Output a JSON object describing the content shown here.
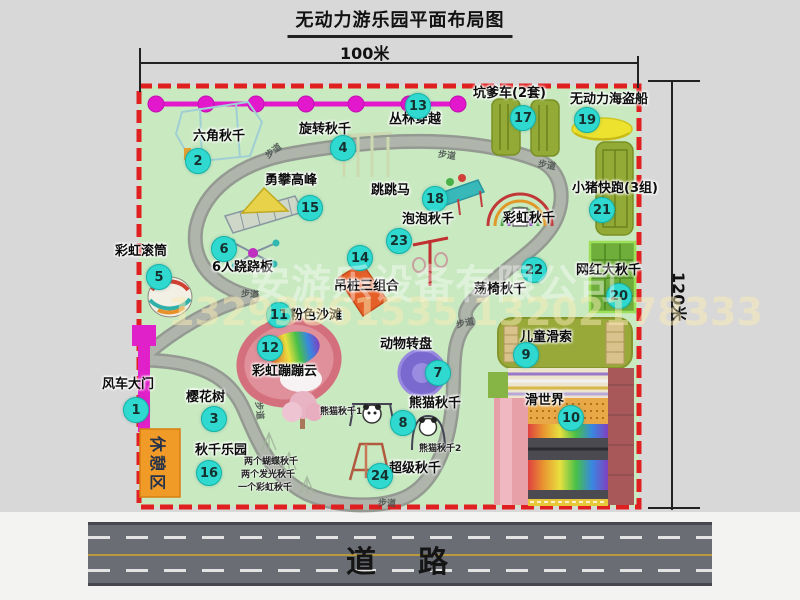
{
  "title": "无动力游乐园平面布局图",
  "dimensions": {
    "width_label": "100米",
    "height_label": "120米"
  },
  "road": {
    "label": "道　路"
  },
  "watermark": {
    "company": "安游乐设备有限公司",
    "phone": "13293861535 13202178333"
  },
  "rest_area": {
    "label": "休憩区"
  },
  "colors": {
    "map_green": "#c9e9c1",
    "border_red": "#e02020",
    "badge_cyan": "#2fd9cf",
    "zipline_magenta": "#e318cd",
    "gate_magenta": "#e020c8",
    "rest_orange": "#f09a28",
    "road_gray": "#6a6d74",
    "path_gray": "#afb5ab"
  },
  "attractions": [
    {
      "num": "1",
      "label": "风车大门",
      "lx": 102,
      "ly": 378,
      "bx": 136,
      "by": 410
    },
    {
      "num": "2",
      "label": "六角秋千",
      "lx": 193,
      "ly": 130,
      "bx": 198,
      "by": 161
    },
    {
      "num": "3",
      "label": "樱花树",
      "lx": 186,
      "ly": 391,
      "bx": 214,
      "by": 419
    },
    {
      "num": "4",
      "label": "旋转秋千",
      "lx": 299,
      "ly": 123,
      "bx": 343,
      "by": 148
    },
    {
      "num": "5",
      "label": "彩虹滚筒",
      "lx": 115,
      "ly": 245,
      "bx": 159,
      "by": 277
    },
    {
      "num": "6",
      "label": "6人跷跷板",
      "lx": 212,
      "ly": 261,
      "bx": 224,
      "by": 249
    },
    {
      "num": "7",
      "label": "动物转盘",
      "lx": 380,
      "ly": 338,
      "bx": 438,
      "by": 373
    },
    {
      "num": "8",
      "label": "熊猫秋千",
      "lx": 409,
      "ly": 397,
      "bx": 403,
      "by": 423
    },
    {
      "num": "9",
      "label": "儿童滑索",
      "lx": 520,
      "ly": 331,
      "bx": 526,
      "by": 355
    },
    {
      "num": "10",
      "label": "滑世界",
      "lx": 525,
      "ly": 394,
      "bx": 571,
      "by": 418
    },
    {
      "num": "11",
      "label": "粉色沙滩",
      "lx": 290,
      "ly": 309,
      "bx": 279,
      "by": 315
    },
    {
      "num": "12",
      "label": "彩虹蹦蹦云",
      "lx": 252,
      "ly": 365,
      "bx": 270,
      "by": 348
    },
    {
      "num": "13",
      "label": "丛林穿越",
      "lx": 389,
      "ly": 113,
      "bx": 418,
      "by": 106
    },
    {
      "num": "14",
      "label": "吊桩三组合",
      "lx": 334,
      "ly": 280,
      "bx": 360,
      "by": 258
    },
    {
      "num": "15",
      "label": "勇攀高峰",
      "lx": 265,
      "ly": 174,
      "bx": 310,
      "by": 208
    },
    {
      "num": "16",
      "label": "秋千乐园",
      "lx": 195,
      "ly": 444,
      "bx": 209,
      "by": 473
    },
    {
      "num": "17",
      "label": "坑爹车(2套)",
      "lx": 473,
      "ly": 87,
      "bx": 523,
      "by": 118
    },
    {
      "num": "18",
      "label": "跳跳马",
      "lx": 371,
      "ly": 184,
      "bx": 435,
      "by": 199
    },
    {
      "num": "19",
      "label": "无动力海盗船",
      "lx": 570,
      "ly": 93,
      "bx": 587,
      "by": 120
    },
    {
      "num": "20",
      "label": "网红大秋千",
      "lx": 576,
      "ly": 264,
      "bx": 619,
      "by": 296
    },
    {
      "num": "21",
      "label": "小猪快跑(3组)",
      "lx": 572,
      "ly": 182,
      "bx": 602,
      "by": 210
    },
    {
      "num": "22",
      "label": "荡椅秋千",
      "lx": 474,
      "ly": 283,
      "bx": 534,
      "by": 270
    },
    {
      "num": "23",
      "label": "泡泡秋千",
      "lx": 402,
      "ly": 213,
      "bx": 399,
      "by": 241
    },
    {
      "num": "24",
      "label": "超级秋千",
      "lx": 389,
      "ly": 462,
      "bx": 380,
      "by": 476
    },
    {
      "num": "",
      "label": "彩虹秋千",
      "lx": 503,
      "ly": 212,
      "bx": 0,
      "by": 0
    }
  ],
  "small_notes": [
    {
      "text": "熊猫秋千1",
      "x": 320,
      "y": 404
    },
    {
      "text": "熊猫秋千2",
      "x": 419,
      "y": 441
    },
    {
      "text": "两个蝴蝶秋千",
      "x": 244,
      "y": 454
    },
    {
      "text": "两个发光秋千",
      "x": 241,
      "y": 467
    },
    {
      "text": "一个彩虹秋千",
      "x": 238,
      "y": 480
    }
  ],
  "path_labels": [
    {
      "text": "步道",
      "x": 264,
      "y": 144,
      "rot": -38
    },
    {
      "text": "步道",
      "x": 438,
      "y": 148,
      "rot": 8
    },
    {
      "text": "步道",
      "x": 538,
      "y": 158,
      "rot": 10
    },
    {
      "text": "步道",
      "x": 241,
      "y": 287,
      "rot": 4
    },
    {
      "text": "步道",
      "x": 456,
      "y": 316,
      "rot": -12
    },
    {
      "text": "步道",
      "x": 378,
      "y": 496,
      "rot": 2
    },
    {
      "text": "步道",
      "x": 251,
      "y": 404,
      "rot": 84
    }
  ]
}
